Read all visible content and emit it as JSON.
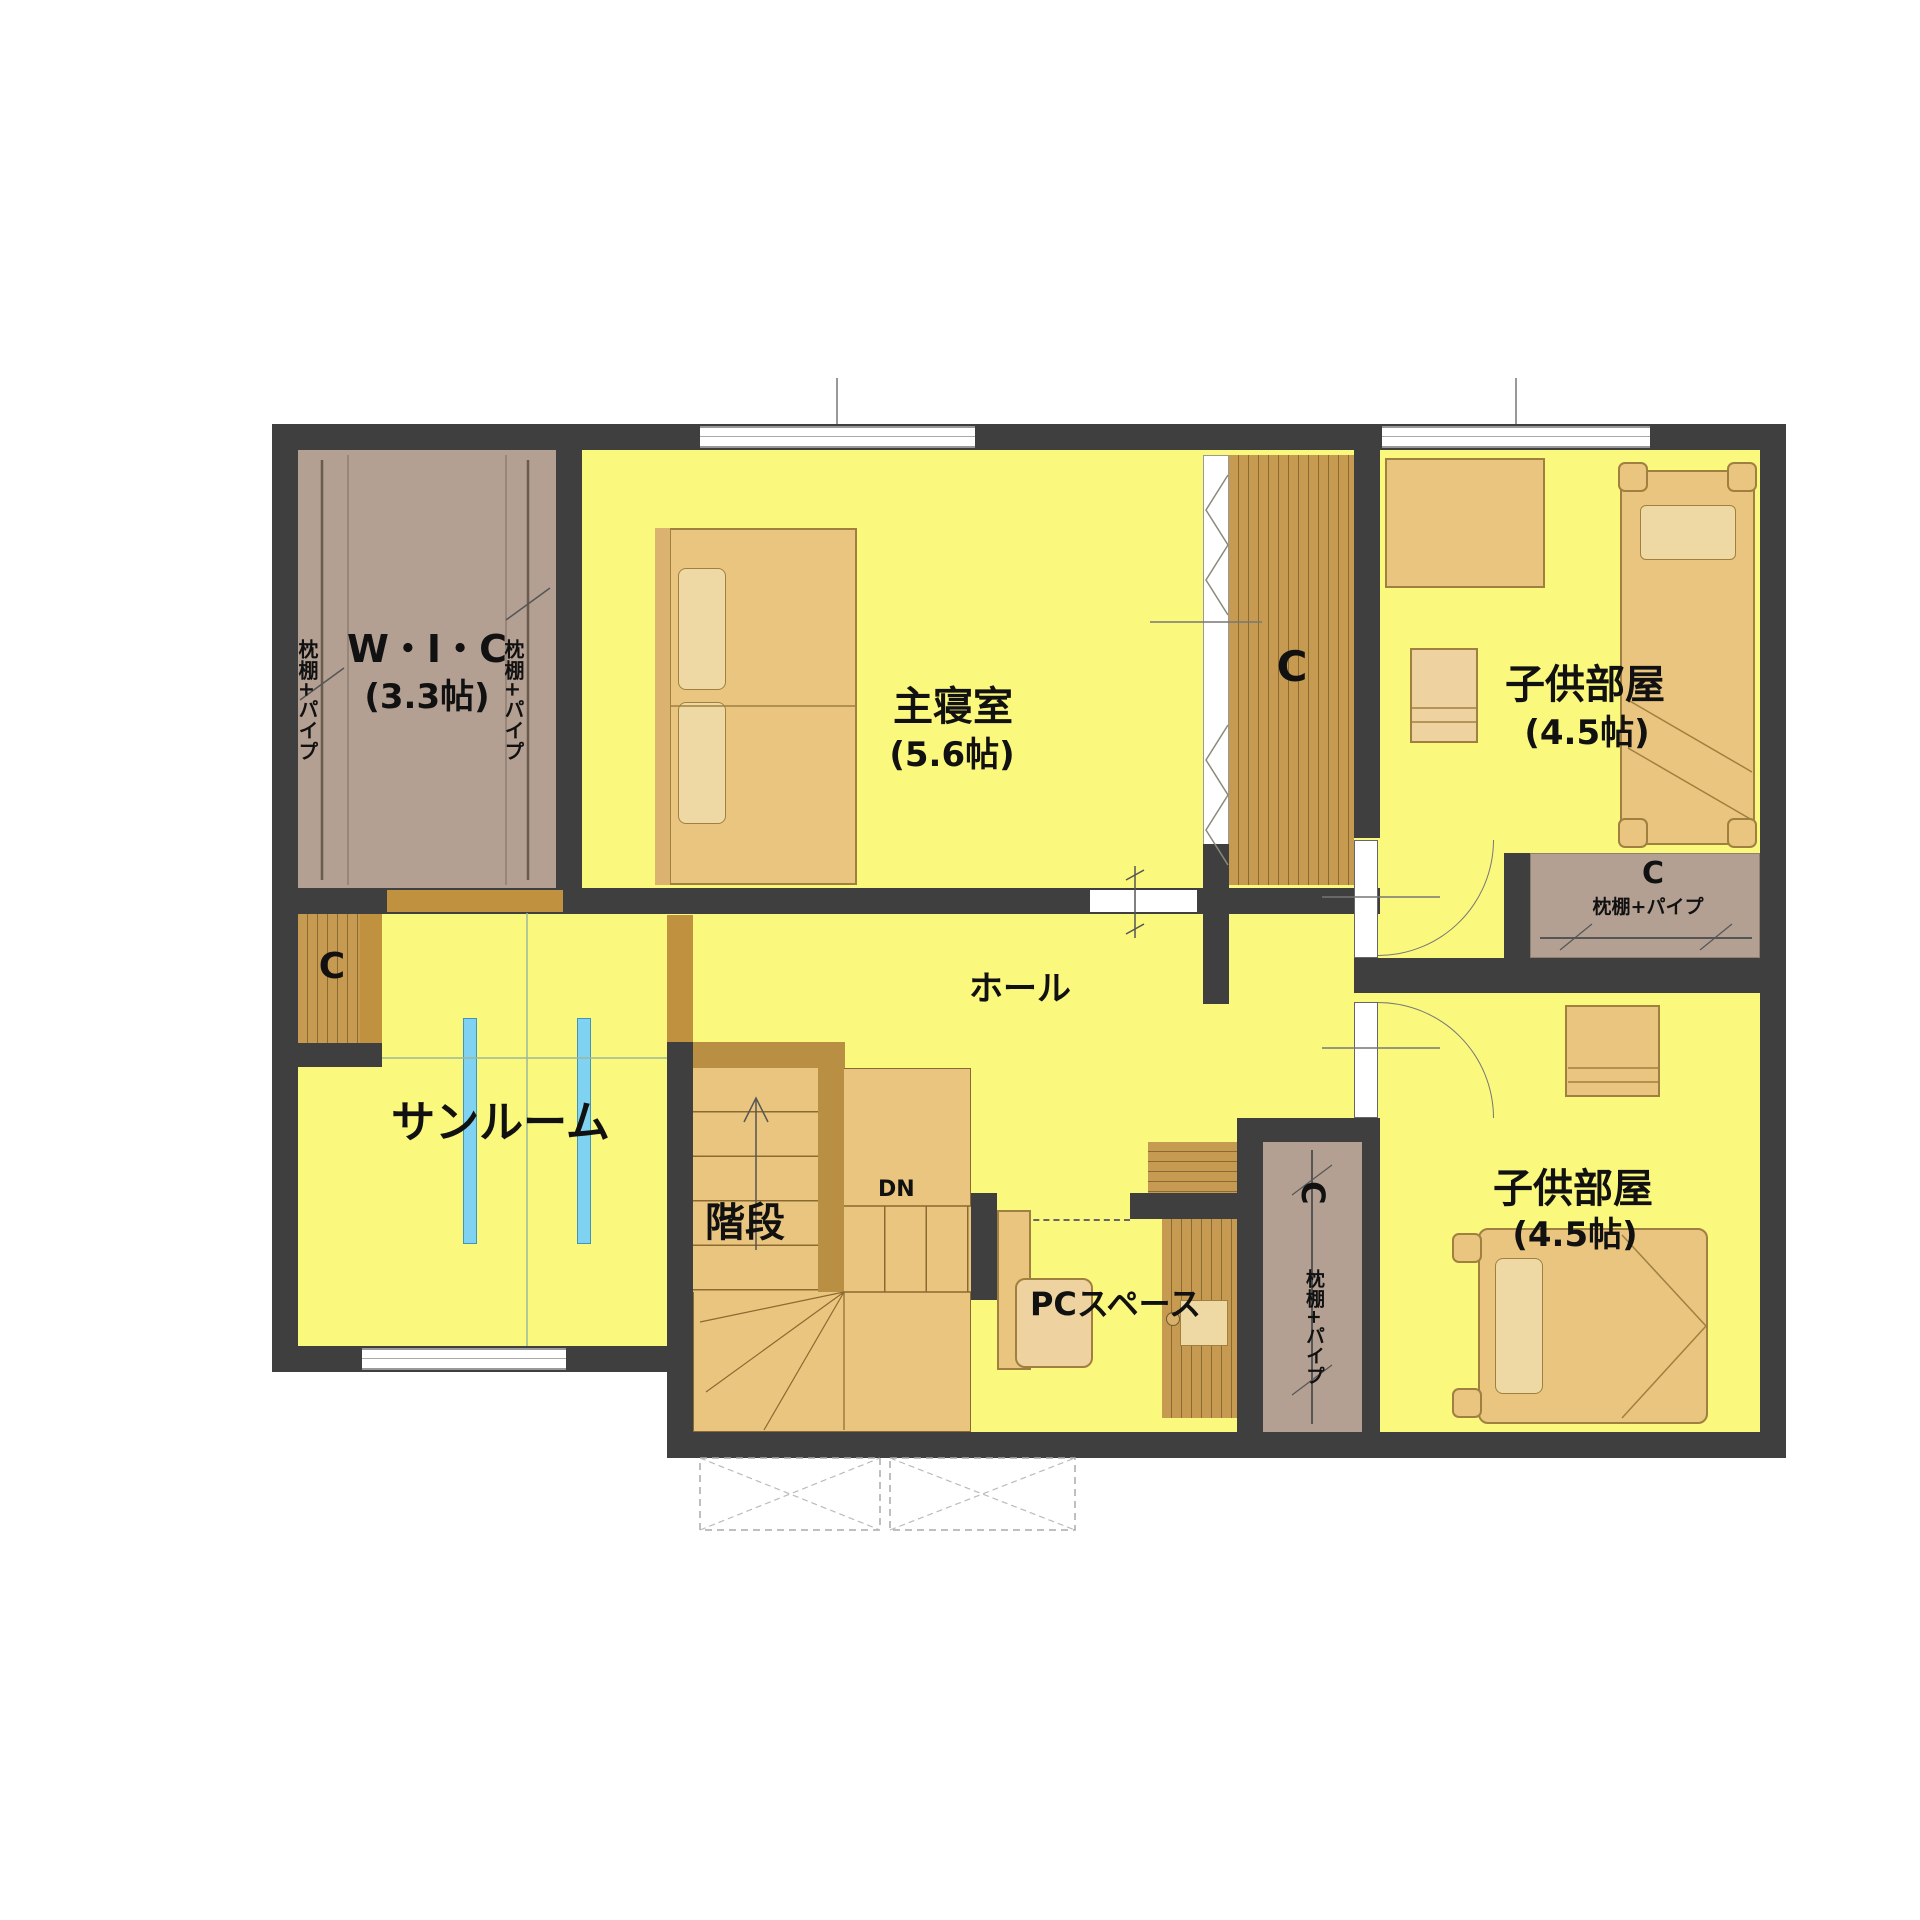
{
  "plan_type": "2F residential floor plan (Japanese)",
  "rooms": {
    "wic": {
      "name": "W・I・C",
      "area": "(3.3帖)"
    },
    "master_bedroom": {
      "name": "主寝室",
      "area": "(5.6帖)"
    },
    "kids_room_north": {
      "name": "子供部屋",
      "area": "(4.5帖)"
    },
    "kids_room_south": {
      "name": "子供部屋",
      "area": "(4.5帖)"
    },
    "hall": {
      "name": "ホール"
    },
    "sunroom": {
      "name": "サンルーム"
    },
    "stairs": {
      "name": "階段",
      "direction": "DN"
    },
    "pc_space": {
      "name": "PCスペース"
    }
  },
  "closet": {
    "code": "C",
    "shelf_pipe": "枕棚+パイプ"
  },
  "colors": {
    "wall": "#3f3f3f",
    "floor_yellow": "#fbf87e",
    "closet_fill": "#b3a093",
    "wood_stripe": "#c79a52",
    "wood_stripe_dark": "#8a6a30",
    "furniture_tan": "#e9c57f",
    "furniture_border": "#a08040",
    "opening_brown": "#c0913f",
    "laundry_pole_blue": "#7fd2f2"
  }
}
